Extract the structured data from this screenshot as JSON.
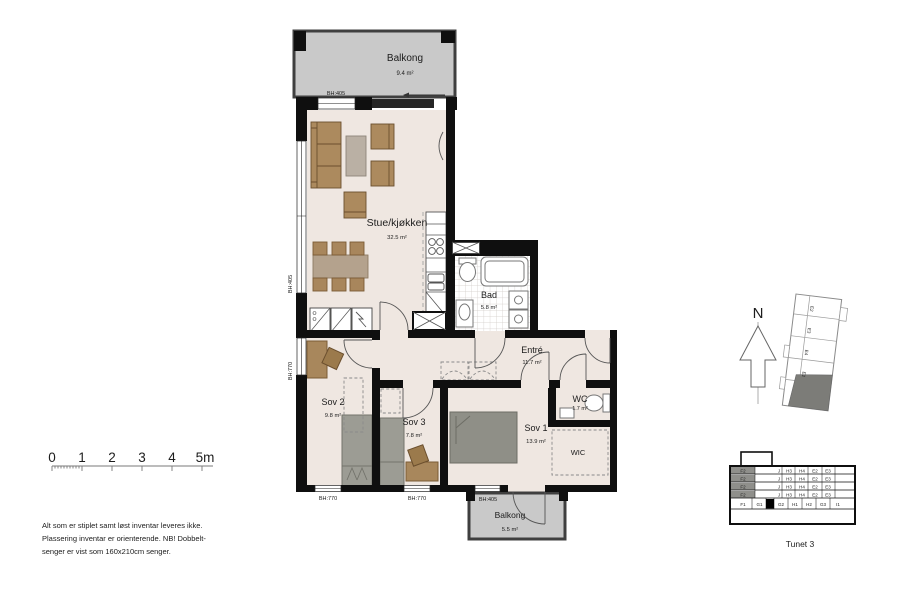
{
  "plan": {
    "rooms": [
      {
        "name": "Balkong",
        "area": "9.4 m²"
      },
      {
        "name": "Stue/kjøkken",
        "area": "32.5 m²"
      },
      {
        "name": "Bad",
        "area": "5.8 m²"
      },
      {
        "name": "Entré",
        "area": "11.7 m²"
      },
      {
        "name": "WC",
        "area": "1.7 m²"
      },
      {
        "name": "Sov 2",
        "area": "9.8 m²"
      },
      {
        "name": "Sov 3",
        "area": "7.8 m²"
      },
      {
        "name": "Sov 1",
        "area": "13.9 m²"
      },
      {
        "name": "WIC",
        "area": ""
      },
      {
        "name": "Balkong",
        "area": "5.5 m²"
      }
    ],
    "window_labels": {
      "top": "BH:405",
      "left_upper": "BH:405",
      "left_lower": "BH:770",
      "bottom_sov2": "BH:770",
      "bottom_sov3": "BH:770",
      "balcony": "BH:405"
    }
  },
  "scalebar": {
    "labels": [
      "0",
      "1",
      "2",
      "3",
      "4",
      "5m"
    ]
  },
  "notes": {
    "line1": "Alt som er stiplet samt løst inventar leveres ikke.",
    "line2": "Plassering inventar er orienterende. NB! Dobbelt-",
    "line3": "senger er vist som 160x210cm senger."
  },
  "compass": {
    "label": "N"
  },
  "keyplan": {
    "units": [
      "E2",
      "E3",
      "E4",
      "E2"
    ]
  },
  "facade": {
    "upper_row": [
      "F2",
      "J",
      "H3",
      "H4",
      "E2",
      "E3"
    ],
    "ground_row": [
      "F1",
      "G1",
      "G2",
      "H1",
      "H2",
      "G3",
      "I1"
    ]
  },
  "project": {
    "title": "Tunet 3"
  },
  "colors": {
    "wall": "#0f0f0f",
    "floor": "#efe7e1",
    "balcony": "#c9c9c9",
    "furniture_wood": "#a8875c",
    "bed": "#9c9c94",
    "table": "#b6a99b",
    "highlight": "#000000"
  }
}
